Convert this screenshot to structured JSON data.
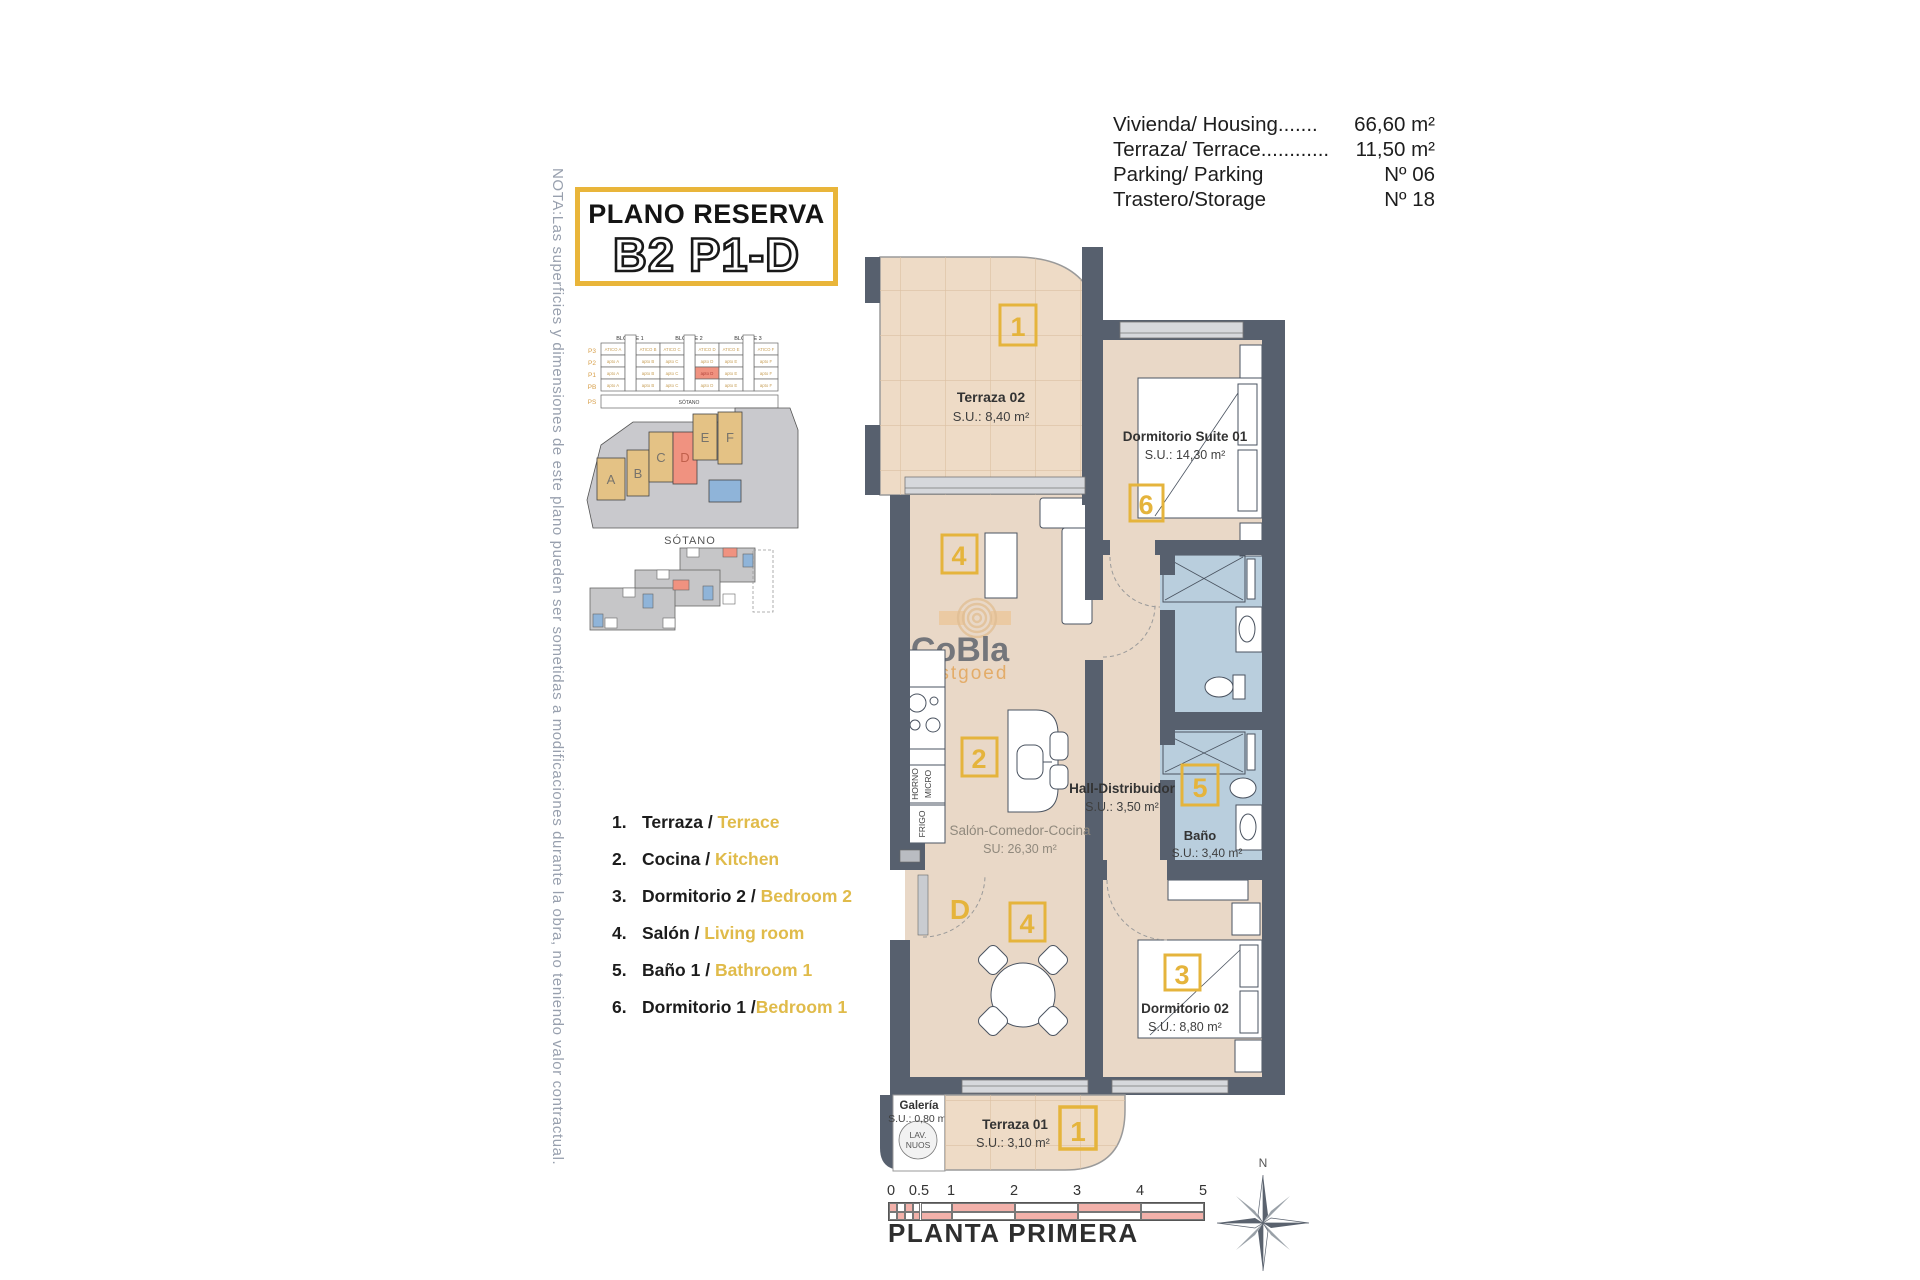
{
  "info_panel": {
    "rows": [
      {
        "label": "Vivienda/ Housing.......",
        "value": "66,60 m²"
      },
      {
        "label": "Terraza/ Terrace............",
        "value": "11,50 m²"
      },
      {
        "label": "Parking/ Parking",
        "value": "Nº 06"
      },
      {
        "label": "Trastero/Storage",
        "value": "Nº 18"
      }
    ]
  },
  "title_box": {
    "line1": "PLANO RESERVA",
    "line2": "B2 P1-D"
  },
  "note_vertical": "NOTA:Las superficies y dimensiones de este plano pueden ser sometidas a modificaciones durante la obra, no teniendo valor contractual.",
  "legend": {
    "items": [
      {
        "num": "1.",
        "es": "Terraza / ",
        "en": "Terrace"
      },
      {
        "num": "2.",
        "es": "Cocina / ",
        "en": "Kitchen"
      },
      {
        "num": "3.",
        "es": "Dormitorio 2 / ",
        "en": "Bedroom 2"
      },
      {
        "num": "4.",
        "es": "Salón / ",
        "en": "Living room"
      },
      {
        "num": "5.",
        "es": "Baño 1 / ",
        "en": "Bathroom 1"
      },
      {
        "num": "6.",
        "es": "Dormitorio 1 /",
        "en": "Bedroom 1"
      }
    ]
  },
  "mini_block": {
    "bloques": [
      "BLOQUE 1",
      "BLOQUE 2",
      "BLOQUE 3"
    ],
    "floors": [
      "P3",
      "P2",
      "P1",
      "PB",
      "PS"
    ],
    "atico_row": [
      "ATICO A",
      "ATICO B",
      "ATICO C",
      "ATICO D",
      "ATICO E",
      "ATICO F"
    ],
    "apt_row": [
      "apto A",
      "apto B",
      "apto C",
      "apto D",
      "apto E",
      "apto F"
    ],
    "sotano": "SÓTANO"
  },
  "site_plan": {
    "buildings": [
      "A",
      "B",
      "C",
      "D",
      "E",
      "F"
    ]
  },
  "sotano_plan": {
    "label": "SÓTANO"
  },
  "watermark": {
    "line1": "CoBla",
    "line2": "Vastgoed"
  },
  "plan": {
    "rooms": {
      "terraza02": {
        "name": "Terraza 02",
        "area": "S.U.: 8,40 m²",
        "marker": "1"
      },
      "dormitorio_suite": {
        "name": "Dormitorio Suite 01",
        "area": "S.U.: 14,30 m²",
        "marker": "6"
      },
      "hall": {
        "name": "Hall-Distribuidor",
        "area": "S.U.: 3,50 m²"
      },
      "bano": {
        "name": "Baño",
        "area": "S.U.: 3,40 m²",
        "marker": "5"
      },
      "salon": {
        "name": "Salón-Comedor-Cocina",
        "area": "SU: 26,30 m²",
        "marker_cocina": "2",
        "marker_salon": "4"
      },
      "dormitorio02": {
        "name": "Dormitorio 02",
        "area": "S.U.: 8,80 m²",
        "marker": "3"
      },
      "galeria": {
        "name": "Galería",
        "area": "S.U.: 0,80 m²"
      },
      "terraza01": {
        "name": "Terraza 01",
        "area": "S.U.: 3,10 m²",
        "marker": "1"
      }
    },
    "entrance_label": "D",
    "kitchen_labels": {
      "oven": "HORNO",
      "micro": "MICRO",
      "fridge": "FRIGO"
    },
    "laundry_labels": {
      "l1": "LAV.",
      "l2": "NUOS"
    }
  },
  "footer": {
    "scale_ticks": [
      "0",
      "0.5",
      "1",
      "2",
      "3",
      "4",
      "5"
    ],
    "plan_name": "PLANTA PRIMERA",
    "north": "N"
  },
  "colors": {
    "wall": "#57606e",
    "floor": "#e9d8c7",
    "bath_floor": "#b9cedd",
    "accent_yellow": "#e5b43c",
    "highlight_red": "#f09280",
    "tile_line": "#dcc0a2",
    "legend_en": "#e0bb4a",
    "scale_pink": "#f2b1aa"
  }
}
